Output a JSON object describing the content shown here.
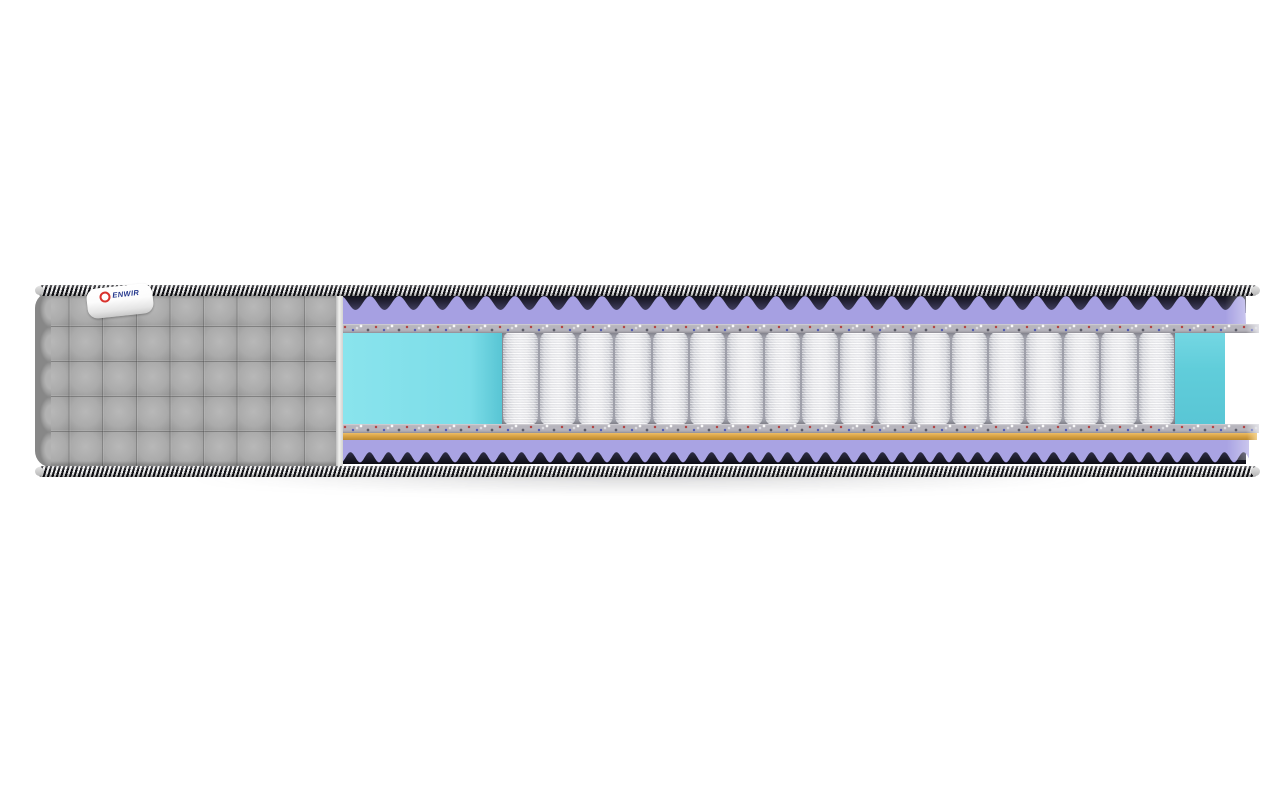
{
  "scene": {
    "background": "#ffffff",
    "subject": "mattress-cutaway-product-photo"
  },
  "label": {
    "text": "ENWIR",
    "logo_icon": "red-ring-logo"
  },
  "structure": {
    "spring_count": 18,
    "quilt_rows": 5,
    "quilt_cols": 9,
    "top_wave_period": 29,
    "bottom_wave_period": 19
  },
  "colors": {
    "page_bg": "#ffffff",
    "piping_dark": "#141419",
    "piping_light": "#efefef",
    "cover_gray": "#a6a6a6",
    "foam_purple": "#a6a0e2",
    "foam_purple_bottom": "#a9a3e3",
    "wave_shadow_dark": "#0c0c14",
    "wave_shadow_light": "#4c4a6e",
    "felt_gray": "#b7b5bd",
    "cyan_foam": "#7edee8",
    "cyan_foam_deep": "#5ecbd9",
    "spring_white": "#f6f6f8",
    "spring_shade": "#b0b1ba",
    "coir_orange": "#d9a344",
    "label_text": "#23368c",
    "label_logo": "#d9322d"
  }
}
